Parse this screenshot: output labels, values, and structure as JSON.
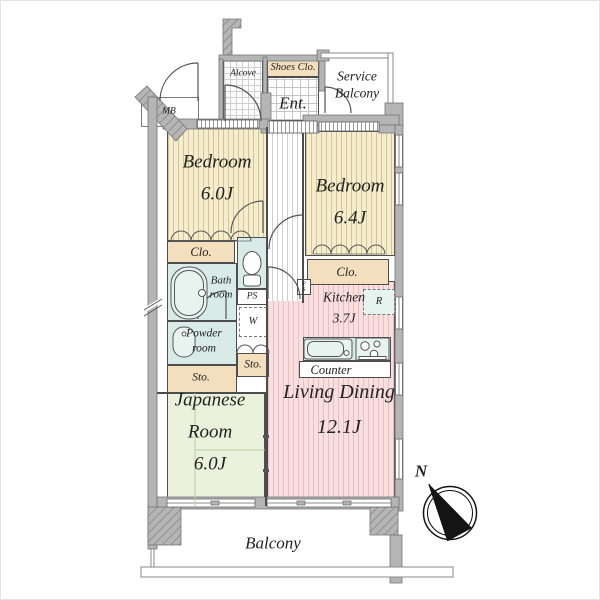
{
  "title": "Apartment floor plan 3LDK",
  "colors": {
    "wall": "#b5b5b5",
    "wall_edge": "#757575",
    "line": "#4d4d4d",
    "bedroom_floor": "#f4edcf",
    "bedroom_stripe": "#d8c48e",
    "living_floor": "#f9dfdf",
    "living_stripe": "#eabfbf",
    "tatami_floor": "#eaf2dc",
    "tatami_line": "#bccf9e",
    "wet": "#d8ebe6",
    "fixture": "#e7f3ee",
    "tan": "#f3dfbd",
    "hall_stripe": "#cfcfcf",
    "text": "#222222"
  },
  "labels": {
    "alcove": "Alcove",
    "shoes_closet": "Shoes Clo.",
    "entrance": "Ent.",
    "service_line1": "Service",
    "service_line2": "Balcony",
    "meter_box": "MB",
    "bedroom1_name": "Bedroom",
    "bedroom1_size": "6.0J",
    "bedroom2_name": "Bedroom",
    "bedroom2_size": "6.4J",
    "closet1": "Clo.",
    "closet2": "Clo.",
    "bath_line1": "Bath",
    "bath_line2": "room",
    "pipe_space": "PS",
    "pipe_space_v1": "P",
    "pipe_space_v2": "S",
    "washer": "W",
    "powder_line1": "Powder",
    "powder_line2": "room",
    "storage1": "Sto.",
    "storage2": "Sto.",
    "kitchen_name": "Kitchen",
    "kitchen_size": "3.7J",
    "refrigerator": "R",
    "counter": "Counter",
    "living_name": "Living Dining",
    "living_size": "12.1J",
    "japanese_line1": "Japanese",
    "japanese_line2": "Room",
    "japanese_line3": "6.0J",
    "balcony": "Balcony",
    "compass_north": "N"
  }
}
